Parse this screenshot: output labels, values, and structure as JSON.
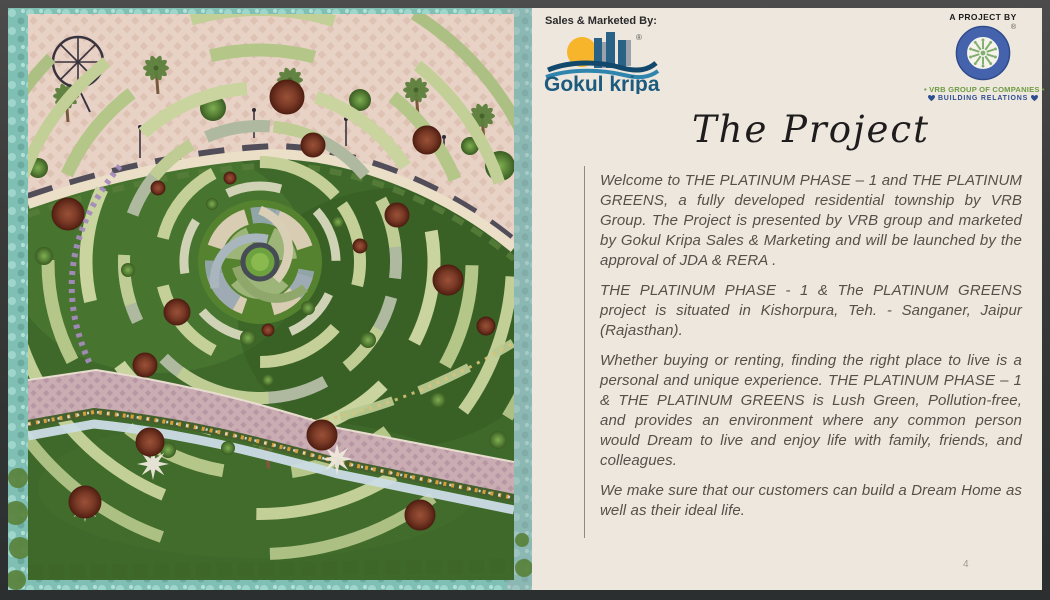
{
  "page": {
    "number": "4"
  },
  "branding": {
    "sales_by_label": "Sales & Marketed By:",
    "gokul_kripa": {
      "name": "Gokul kripa",
      "registered_mark": "®"
    },
    "project_by_label": "A PROJECT BY",
    "vrb": {
      "registered_mark": "®",
      "group_line": "• VRB GROUP OF COMPANIES •",
      "tagline": "BUILDING RELATIONS"
    }
  },
  "content": {
    "title": "The Project",
    "paragraphs": [
      "Welcome to THE PLATINUM PHASE – 1 and THE PLATINUM GREENS, a fully developed residential township by VRB Group. The Project is presented by VRB group and marketed by Gokul Kripa Sales & Marketing and will be launched by the approval of JDA & RERA .",
      "THE PLATINUM PHASE - 1 & The PLATINUM GREENS project is situated in Kishorpura, Teh. - Sanganer, Jaipur (Rajasthan).",
      "Whether buying or renting, finding the right place to live is a personal and unique experience. THE PLATINUM PHASE – 1 & THE PLATINUM GREENS is Lush Green, Pollution-free, and provides an environment where any common person would Dream to live and enjoy life with family, friends, and colleagues.",
      "We make sure that our customers can build a Dream Home as well as their ideal life."
    ]
  },
  "colors": {
    "panel_bg": "#EDE7DE",
    "frame": "#3C3C3C",
    "gokul_blue": "#1D5B7E",
    "vrb_green": "#6F9C43",
    "vrb_blue": "#2D4F92",
    "border_teal": "#7FBFB4"
  }
}
